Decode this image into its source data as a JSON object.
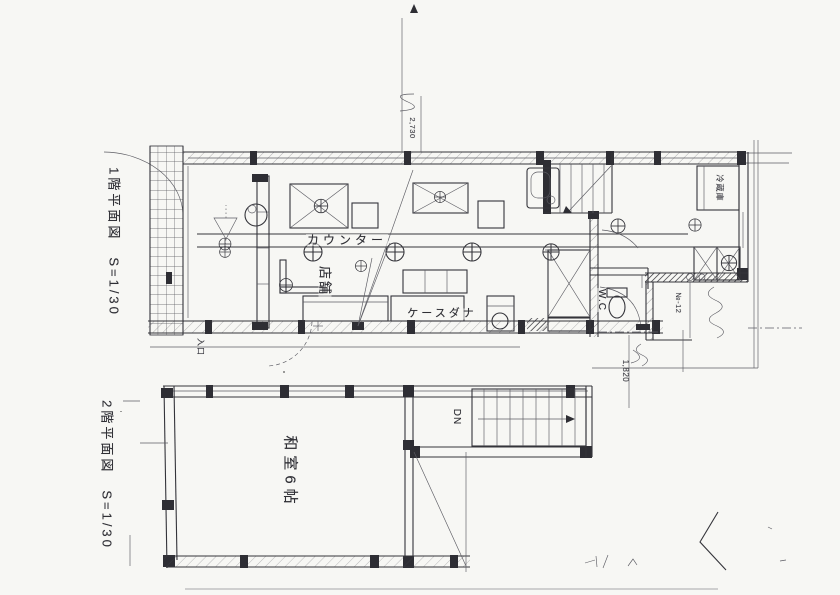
{
  "page": {
    "paper_color": "#f7f7f4",
    "ink_color": "#33333a"
  },
  "first_floor_plan": {
    "title": "1階平面図　S=1/30",
    "labels": {
      "counter": "カウンター",
      "shop": "店舗",
      "display_case": "ケースダナ",
      "toilet": "W.C",
      "refrigerator": "冷蔵庫",
      "entrance_note": "入口"
    },
    "annotations": {
      "top_dimension": "2,730",
      "side_note": "№-12",
      "lower_dimension": "1,820"
    }
  },
  "second_floor_plan": {
    "title": "2階平面図　S=1/30",
    "labels": {
      "tatami_room": "和室6帖",
      "stairs_down": "DN"
    }
  }
}
